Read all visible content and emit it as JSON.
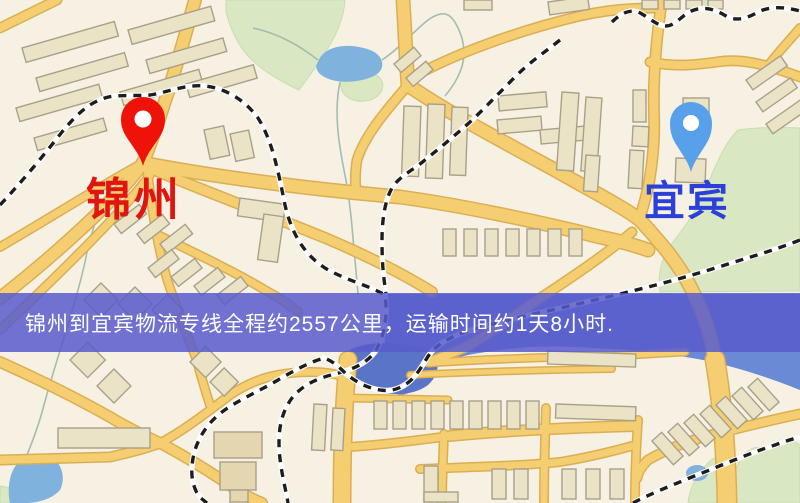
{
  "banner": {
    "text": "锦州到宜宾物流专线全程约2557公里，运输时间约1天8小时."
  },
  "markers": {
    "origin": {
      "label": "锦州"
    },
    "destination": {
      "label": "宜宾"
    }
  },
  "theme": {
    "banner_bg": "rgba(88,90,205,0.85)",
    "banner_text": "#ffffff",
    "origin_pin": "#ee1208",
    "origin_label": "#e01410",
    "dest_pin": "#58a0ea",
    "dest_label": "#2b3fd9",
    "pin_hole": "#ffffff",
    "road_fill": "#f4ce70",
    "road_edge": "#dcae54",
    "water_mid": "#6b8ad6",
    "water_dark": "#5a74c8",
    "water_light": "#7fb2dc",
    "park": "#d9e7c2",
    "building_fill": "#ebe3c6",
    "rail_dash": "#1d1d1d",
    "bg": "#f6f1e2"
  }
}
